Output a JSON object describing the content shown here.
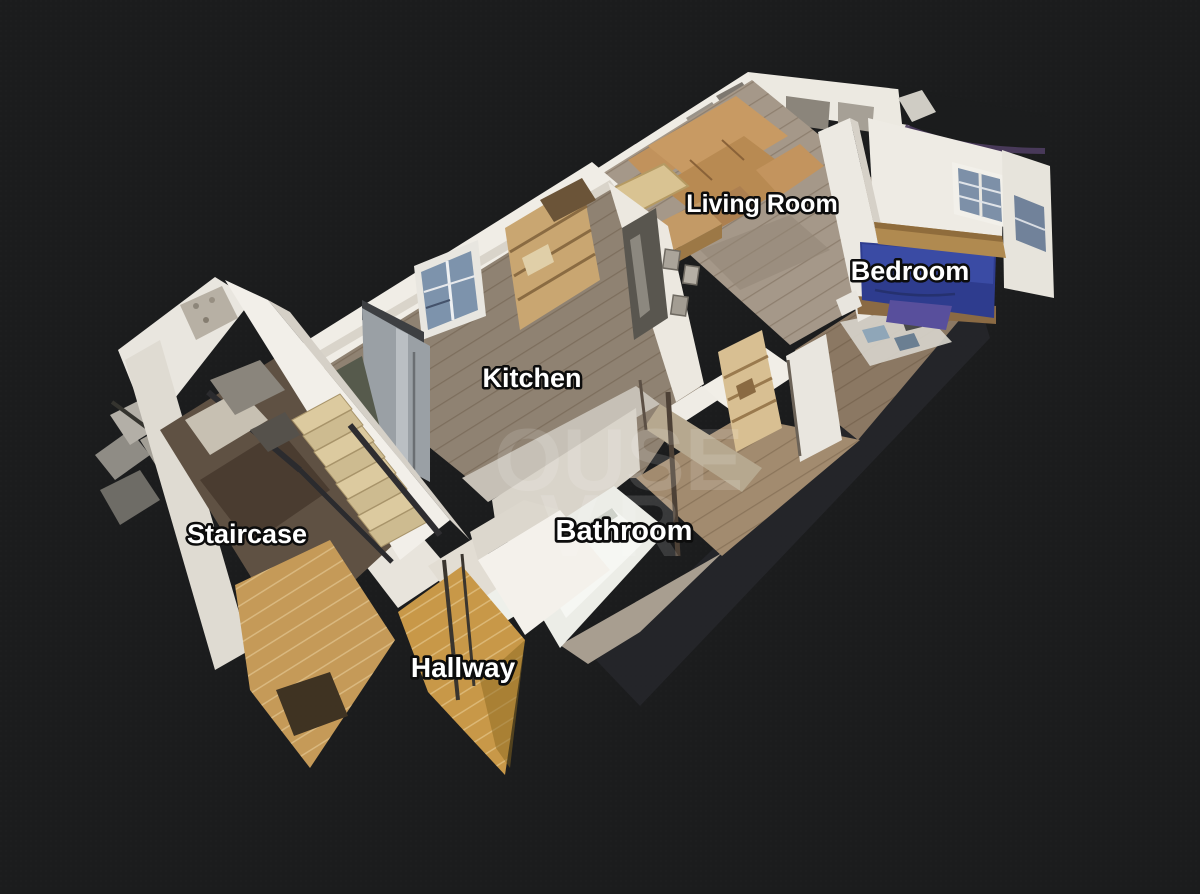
{
  "view": {
    "type": "3d-dollhouse-floorplan",
    "background_color": "#1b1c1d"
  },
  "labels": [
    {
      "id": "living-room",
      "text": "Living Room"
    },
    {
      "id": "bedroom",
      "text": "Bedroom"
    },
    {
      "id": "kitchen",
      "text": "Kitchen"
    },
    {
      "id": "bathroom",
      "text": "Bathroom"
    },
    {
      "id": "staircase",
      "text": "Staircase"
    },
    {
      "id": "hallway",
      "text": "Hallway"
    }
  ],
  "watermark": {
    "lines": [
      "OUSE",
      "VR"
    ],
    "color": "#ffffff",
    "opacity": "0.13"
  },
  "palette": {
    "background": "#1b1c1d",
    "wall_white": "#f0ede6",
    "wall_shaded": "#d6d1c8",
    "floor_kitchen": "#8f8272",
    "floor_living": "#a59889",
    "floor_bedroom": "#8b7863",
    "floor_hallway_amber": "#c89848",
    "stair_wood": "#dcca9f",
    "sofa_tan": "#c89a63",
    "bed_blue": "#2e3c8e",
    "headboard_wood": "#b08a50",
    "tub_white": "#ecede7",
    "window_glass": "#7d93ac",
    "torn_edge_purple": "#4e3d60"
  }
}
